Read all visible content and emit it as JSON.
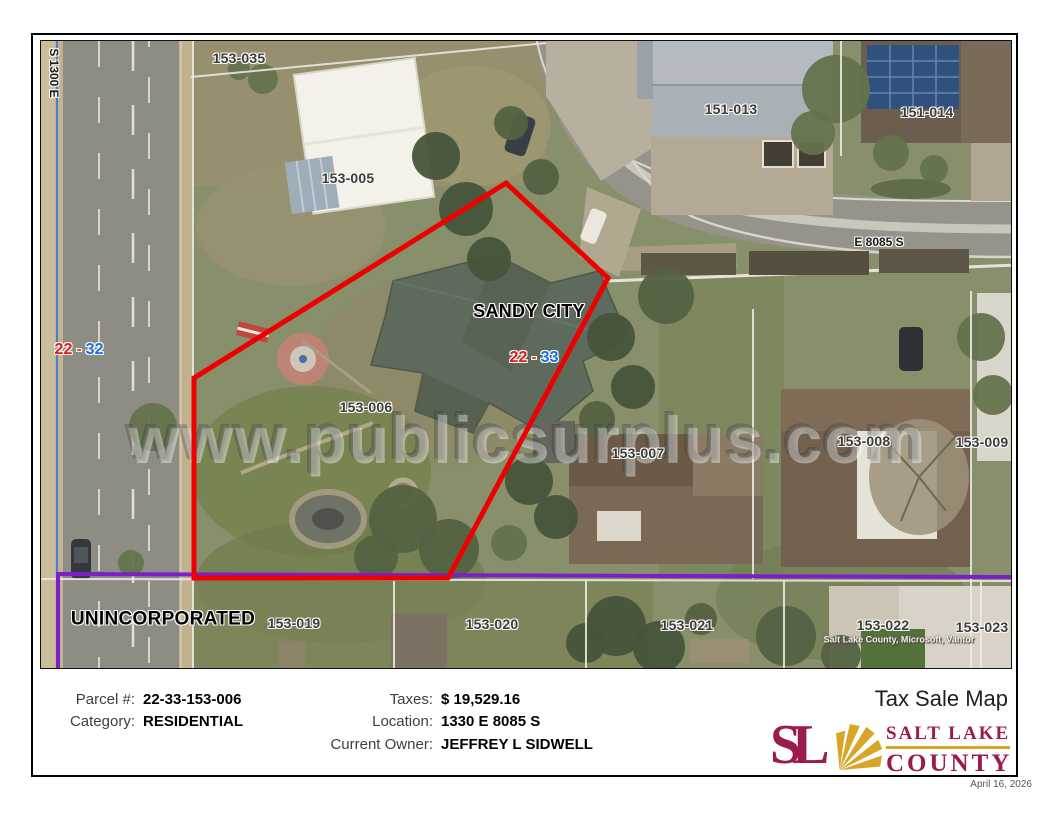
{
  "page": {
    "date": "April 16, 2026"
  },
  "map": {
    "streets": {
      "left": "S 1300 E",
      "top": "E 8085 S"
    },
    "areas": {
      "city": "SANDY CITY",
      "unincorporated": "UNINCORPORATED"
    },
    "sections": {
      "left": {
        "a": "22",
        "dash": "-",
        "b": "32"
      },
      "right": {
        "a": "22",
        "dash": "-",
        "b": "33"
      }
    },
    "parcels": [
      {
        "label": "153-035"
      },
      {
        "label": "153-005"
      },
      {
        "label": "151-013"
      },
      {
        "label": "151-014"
      },
      {
        "label": "153-006"
      },
      {
        "label": "153-007"
      },
      {
        "label": "153-008"
      },
      {
        "label": "153-009"
      },
      {
        "label": "153-019"
      },
      {
        "label": "153-020"
      },
      {
        "label": "153-021"
      },
      {
        "label": "153-022"
      },
      {
        "label": "153-023"
      }
    ],
    "watermark": "www.publicsurplus.com",
    "attribution": "Salt Lake County, Microsoft, Vantor",
    "colors": {
      "subject_outline": "#EE0000",
      "municipal_boundary": "#7C1FC9",
      "road_line_blue": "#4A7FD6"
    }
  },
  "info": {
    "fields": {
      "parcel": {
        "label": "Parcel #:",
        "value": "22-33-153-006"
      },
      "category": {
        "label": "Category:",
        "value": "RESIDENTIAL"
      },
      "taxes": {
        "label": "Taxes:",
        "value": "$ 19,529.16"
      },
      "location": {
        "label": "Location:",
        "value": "1330 E 8085 S"
      },
      "owner": {
        "label": "Current Owner:",
        "value": "JEFFREY L SIDWELL"
      }
    },
    "title": "Tax Sale Map"
  },
  "logo": {
    "monogram": "SL",
    "name_line1": "SALT LAKE",
    "name_line2": "COUNTY",
    "colors": {
      "maroon": "#9B1B4E",
      "gold": "#D8A526"
    }
  }
}
